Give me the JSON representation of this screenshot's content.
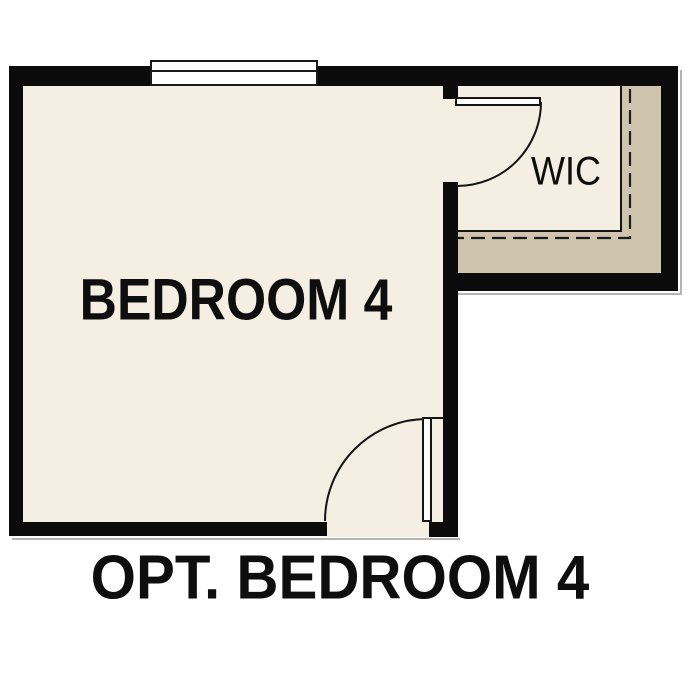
{
  "plan": {
    "caption": "OPT. BEDROOM 4",
    "rooms": {
      "bedroom": {
        "label": "BEDROOM 4"
      },
      "closet": {
        "label": "WIC"
      }
    }
  },
  "palette": {
    "background": "#ffffff",
    "floor": "#f5eee2",
    "closet_floor_accent": "#cfc4ad",
    "wall": "#0b0b0b",
    "text": "#0e0e0e"
  }
}
